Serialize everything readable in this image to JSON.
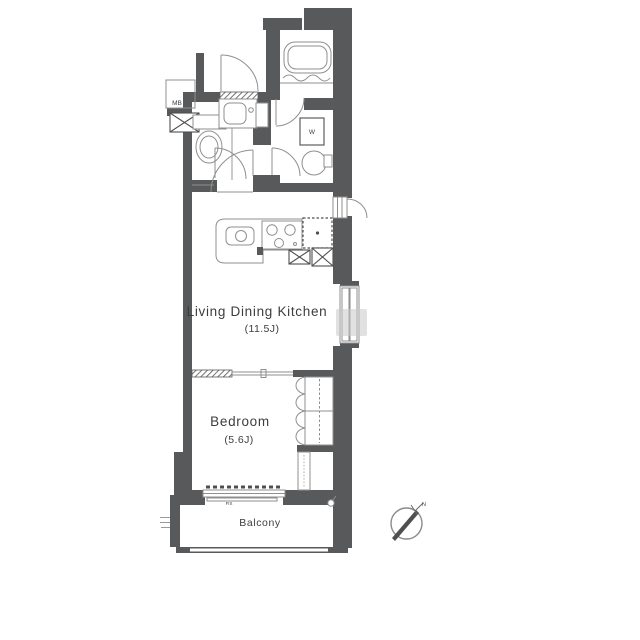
{
  "floor_plan": {
    "rooms": {
      "ldk": {
        "name": "Living Dining Kitchen",
        "size": "(11.5J)"
      },
      "bedroom": {
        "name": "Bedroom",
        "size": "(5.6J)"
      },
      "balcony": {
        "name": "Balcony"
      }
    },
    "labels": {
      "meter_box": "MB",
      "washer": "W",
      "window_fix": "FIX",
      "compass_north": "N"
    },
    "colors": {
      "wall": "#58595b",
      "fixture": "#8f8f8f",
      "strong": "#4f4f4f",
      "text": "#3d3d3d",
      "watermark": "#c9c9c9",
      "background": "#ffffff"
    }
  }
}
